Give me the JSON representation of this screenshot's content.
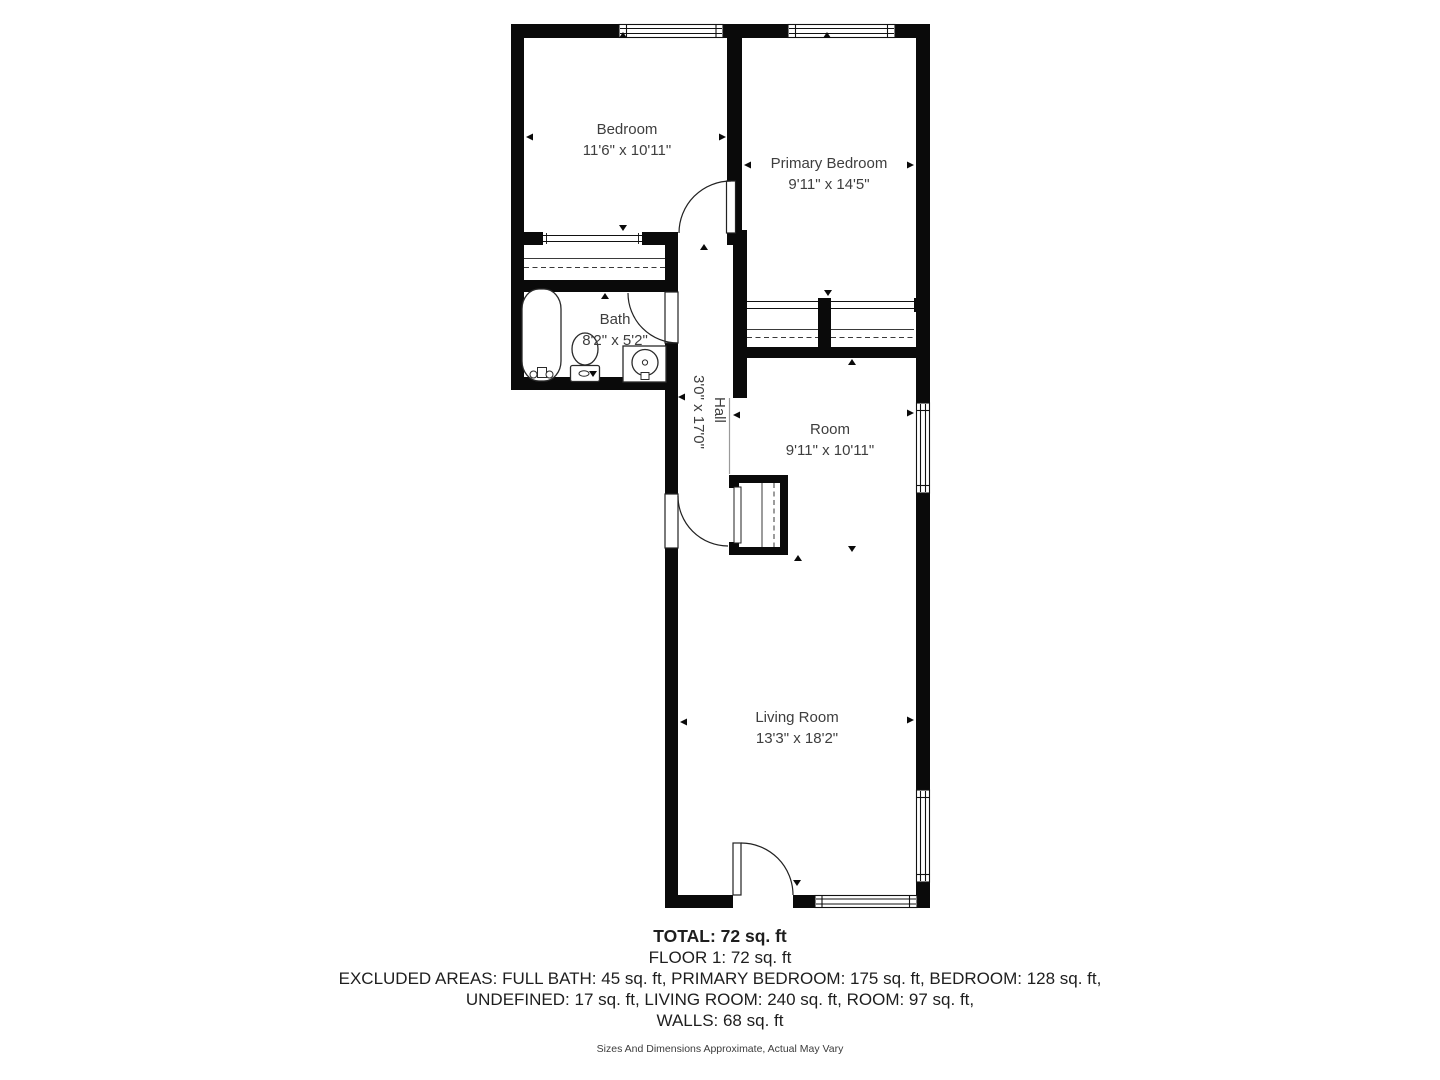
{
  "floorplan": {
    "rooms": [
      {
        "name": "Bedroom",
        "dimensions": "11'6\" x 10'11\""
      },
      {
        "name": "Primary Bedroom",
        "dimensions": "9'11\" x 14'5\""
      },
      {
        "name": "Bath",
        "dimensions": "8'2\" x 5'2\""
      },
      {
        "name": "Hall",
        "dimensions": "3'0\" x 17'0\""
      },
      {
        "name": "Room",
        "dimensions": "9'11\" x 10'11\""
      },
      {
        "name": "Living Room",
        "dimensions": "13'3\" x 18'2\""
      }
    ]
  },
  "summary": {
    "total": "TOTAL: 72 sq. ft",
    "floor": "FLOOR 1: 72 sq. ft",
    "excluded_line1": "EXCLUDED AREAS: FULL BATH: 45 sq. ft, PRIMARY BEDROOM: 175 sq. ft, BEDROOM: 128 sq. ft,",
    "excluded_line2": "UNDEFINED: 17 sq. ft, LIVING ROOM: 240 sq. ft, ROOM: 97 sq. ft,",
    "walls": "WALLS: 68 sq. ft",
    "disclaimer": "Sizes And Dimensions Approximate, Actual May Vary"
  },
  "colors": {
    "wall": "#0a0a0a",
    "room_label_text": "#3e3e3e",
    "summary_text": "#1e1e1e"
  }
}
